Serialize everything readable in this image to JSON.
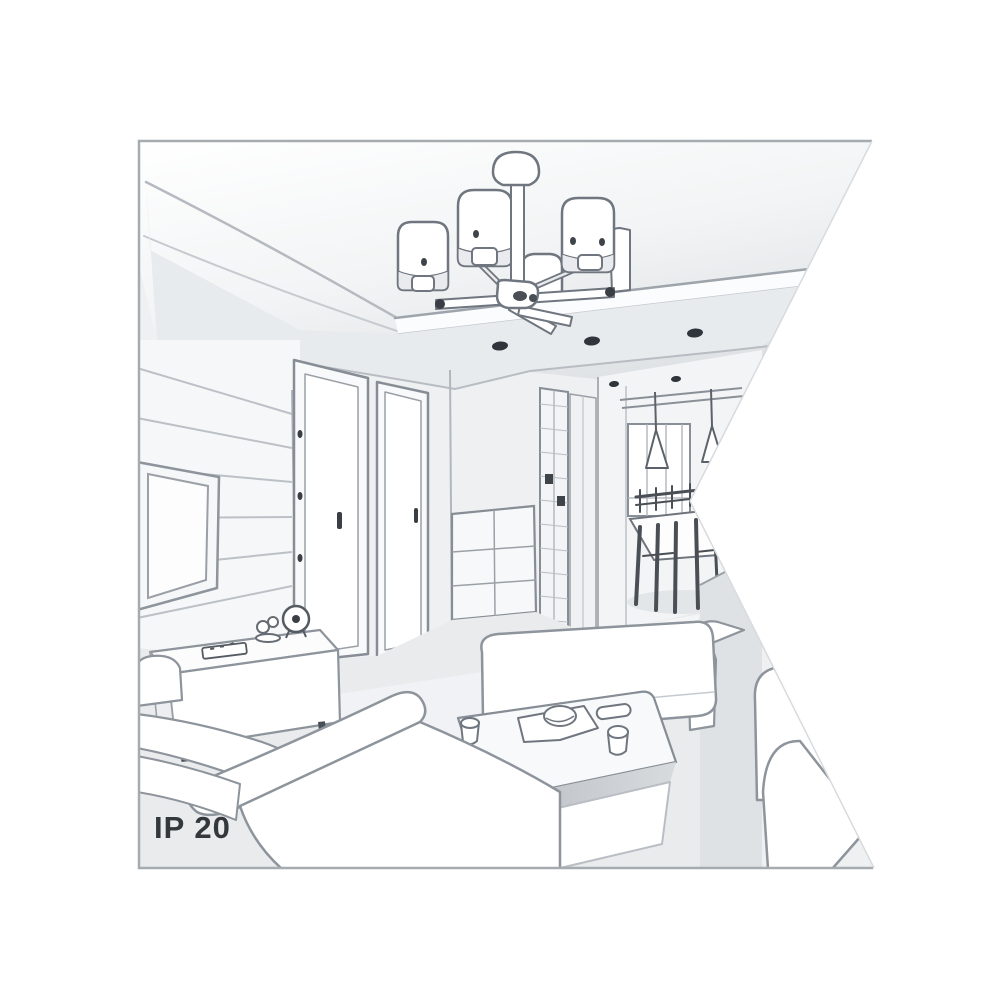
{
  "figure": {
    "rating_label": "IP 20",
    "alt_text": "Black-and-white perspective sketch of a living room interior: a six-shade ceiling chandelier mounted on a dropped ceiling with recessed spotlights, a paneled TV wall with a low sideboard holding a clock and a remote, two interior doors, a slatted wardrobe and a dresser, a hallway leading to a dining area with two cone pendant lamps, a dining table with chairs and a window, white sofas, an ottoman and a coffee table with a tray and cups. A white wedge notch cuts into the right side of the picture.",
    "palette": {
      "background": "#ffffff",
      "frame_border": "#a6abb0",
      "line_medium": "#828994",
      "line_soft": "#b9bec4",
      "line_dark": "#31363c",
      "fill_white": "#ffffff",
      "fill_light": "#f3f4f6",
      "fill_mid": "#e8ebed",
      "fill_shadow": "#cfd3d7",
      "floor": "#e9ebed",
      "text": "#33383d"
    }
  }
}
